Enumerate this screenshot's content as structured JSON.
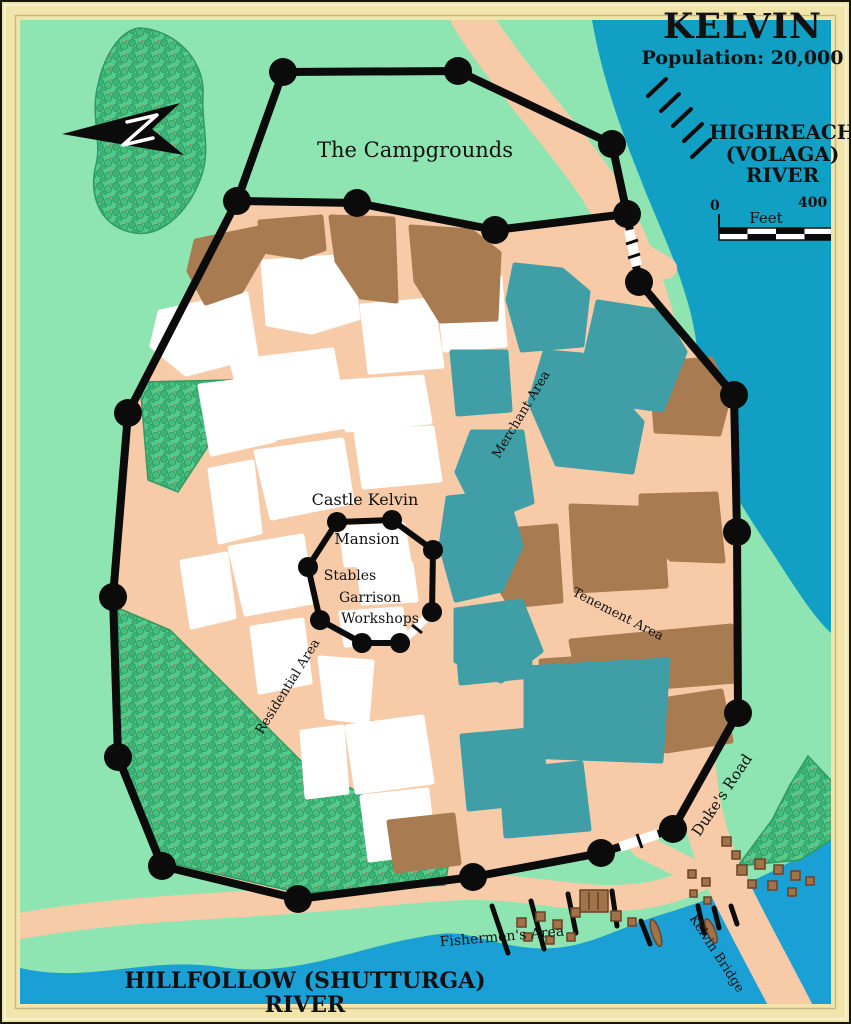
{
  "map": {
    "title": "KELVIN",
    "population": "Population: 20,000",
    "river_northeast": {
      "line1": "HIGHREACH",
      "line2": "(VOLAGA)",
      "line3": "RIVER"
    },
    "river_south": "HILLFOLLOW (SHUTTURGA) RIVER",
    "scale_bar": {
      "start": "0",
      "unit": "Feet",
      "end": "400"
    },
    "areas": {
      "campgrounds": "The Campgrounds",
      "merchant": "Merchant Area",
      "tenement": "Tenement Area",
      "residential": "Residential Area",
      "fishermen": "Fishermen's Area"
    },
    "castle": {
      "name": "Castle Kelvin",
      "mansion": "Mansion",
      "stables": "Stables",
      "garrison": "Garrison",
      "workshops": "Workshops"
    },
    "roads": {
      "dukes_road": "Duke's Road",
      "kelvin_bridge": "Kelvin Bridge"
    },
    "colors": {
      "land": "#8EE5B2",
      "forest": "#55CD8E",
      "road": "#F8CBA8",
      "river_northeast": "#129FC4",
      "river_south": "#1BA0D6",
      "building_white": "#FFFFFF",
      "building_brown": "#A87C50",
      "building_teal": "#3F9EA6",
      "wall": "#0B0B0B",
      "frame": "#F2E5AC",
      "text": "#111111"
    }
  }
}
